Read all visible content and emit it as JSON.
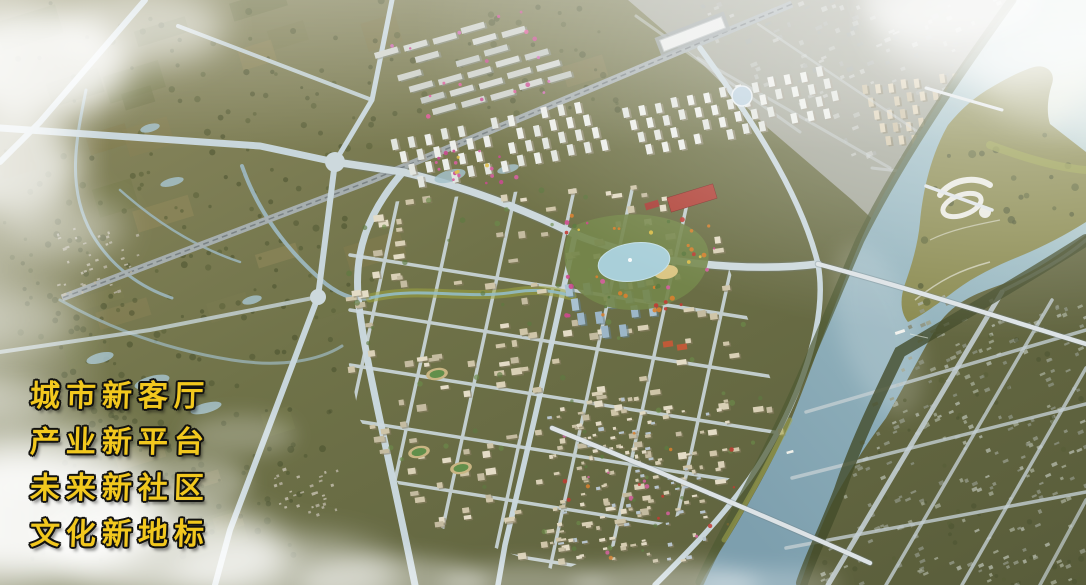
{
  "overlay": {
    "slogan_lines": [
      "城市新客厅",
      "产业新平台",
      "未来新社区",
      "文化新地标"
    ]
  },
  "palette": {
    "slogan_gold": "#F2C81E",
    "slogan_outline": "#121210",
    "terrain_olive": "#6E7046",
    "river_blue": "#8FB2BD",
    "lake_blue": "#A9CFD9",
    "road_light": "#C8D6DB",
    "railway_gray": "#A9B1B3",
    "landmark_roof_red": "#B2463C",
    "fog_white": "#FFFFFF"
  }
}
